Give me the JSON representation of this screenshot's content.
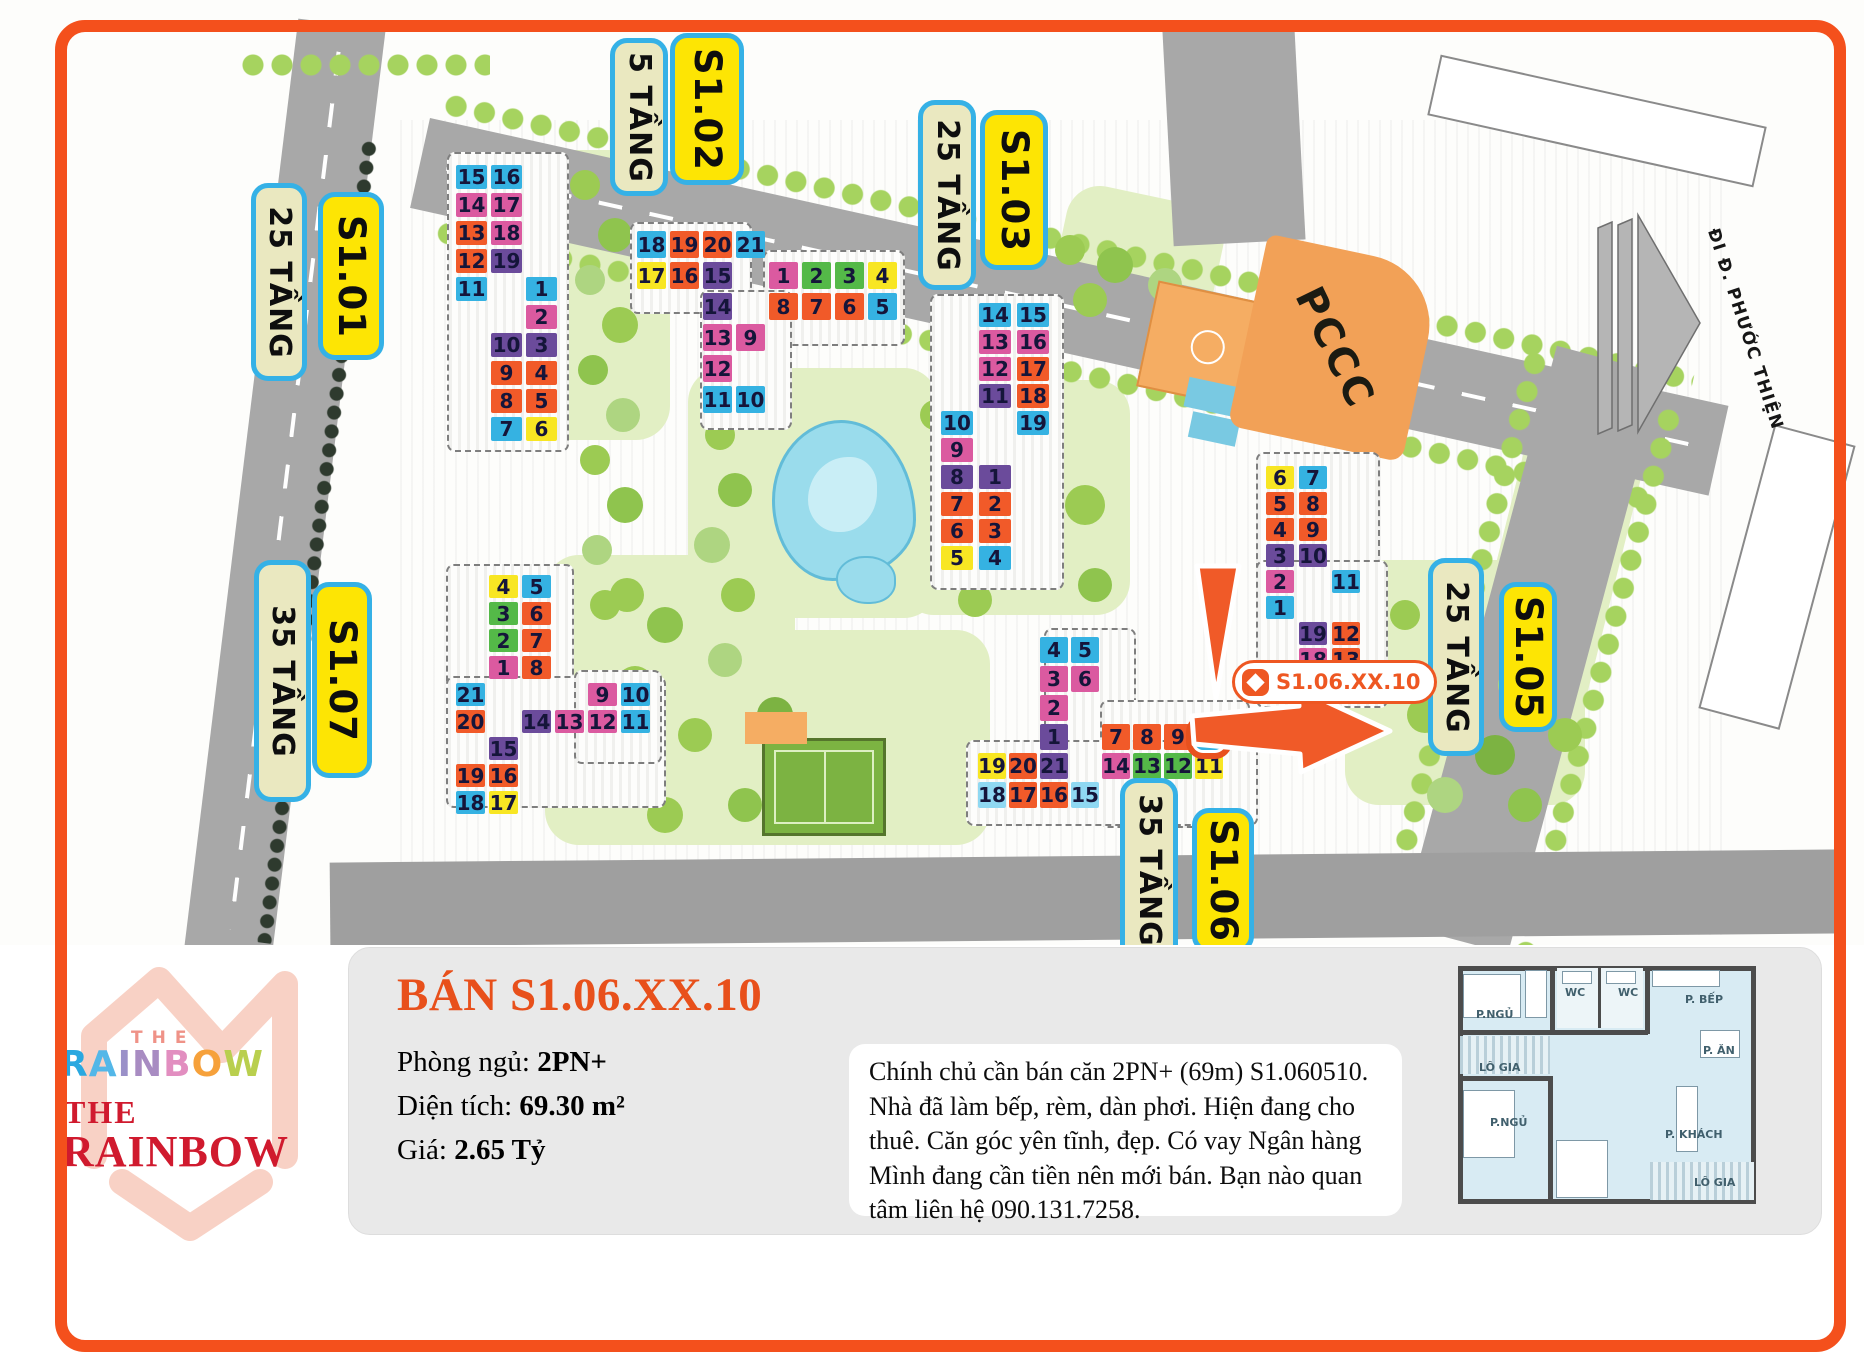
{
  "frame": {
    "border_color": "#f4501c"
  },
  "logo": {
    "the_small": "THE",
    "rainbow_letters": [
      {
        "ch": "R",
        "color": "#29a8e0"
      },
      {
        "ch": "A",
        "color": "#53b7e8"
      },
      {
        "ch": "I",
        "color": "#9a90c8"
      },
      {
        "ch": "N",
        "color": "#a88cc2"
      },
      {
        "ch": "B",
        "color": "#e28ec0"
      },
      {
        "ch": "O",
        "color": "#f6a13b"
      },
      {
        "ch": "W",
        "color": "#b9cf4e"
      }
    ],
    "the_red": "THE",
    "rainbow_red": "RAINBOW"
  },
  "panel": {
    "title": "BÁN S1.06.XX.10",
    "fields": [
      {
        "label": "Phòng ngủ: ",
        "value": "2PN+"
      },
      {
        "label": "Diện tích: ",
        "value": "69.30 m²"
      },
      {
        "label": "Giá: ",
        "value": "2.65 Tỷ"
      }
    ],
    "description": "Chính chủ cần bán căn 2PN+ (69m) S1.060510. Nhà đã làm bếp, rèm, dàn phơi. Hiện đang cho thuê. Căn góc yên tĩnh, đẹp. Có vay Ngân hàng Mình đang cần tiền nên mới bán. Bạn nào quan tâm liên hệ 090.131.7258."
  },
  "floorplan": {
    "labels": [
      {
        "text": "P.NGỦ",
        "x": 1476,
        "y": 1008
      },
      {
        "text": "WC",
        "x": 1565,
        "y": 986
      },
      {
        "text": "WC",
        "x": 1618,
        "y": 986
      },
      {
        "text": "P. BẾP",
        "x": 1685,
        "y": 993
      },
      {
        "text": "P. ĂN",
        "x": 1703,
        "y": 1044
      },
      {
        "text": "LÔ GIA",
        "x": 1479,
        "y": 1061
      },
      {
        "text": "P.NGỦ",
        "x": 1490,
        "y": 1116
      },
      {
        "text": "P. KHÁCH",
        "x": 1665,
        "y": 1128
      },
      {
        "text": "LÔ GIA",
        "x": 1694,
        "y": 1176
      }
    ]
  },
  "map": {
    "street_label": "ĐI Đ. PHƯỚC THIỆN",
    "pccc_label": "PCCC",
    "tooltip": {
      "text": "S1.06.XX.10"
    },
    "palette": {
      "c": "#35b2e2",
      "m": "#db5aa0",
      "o": "#f15a29",
      "p": "#6b4b9b",
      "y": "#f8e623",
      "g": "#54b948",
      "lc": "#8fd8f2"
    },
    "labels": [
      {
        "text": "25 TẦNG",
        "kind": "floors",
        "x": 251,
        "y": 183,
        "w": 56,
        "h": 198
      },
      {
        "text": "S1.01",
        "kind": "name",
        "x": 318,
        "y": 192,
        "w": 66,
        "h": 168
      },
      {
        "text": "5 TẦNG",
        "kind": "floors",
        "x": 610,
        "y": 38,
        "w": 58,
        "h": 158
      },
      {
        "text": "S1.02",
        "kind": "name",
        "x": 670,
        "y": 33,
        "w": 74,
        "h": 152
      },
      {
        "text": "25 TẦNG",
        "kind": "floors",
        "x": 918,
        "y": 100,
        "w": 58,
        "h": 190
      },
      {
        "text": "S1.03",
        "kind": "name",
        "x": 980,
        "y": 110,
        "w": 68,
        "h": 160
      },
      {
        "text": "25 TẦNG",
        "kind": "floors",
        "x": 1428,
        "y": 558,
        "w": 56,
        "h": 198
      },
      {
        "text": "S1.05",
        "kind": "name",
        "x": 1499,
        "y": 582,
        "w": 58,
        "h": 150
      },
      {
        "text": "35 TẦNG",
        "kind": "floors",
        "x": 254,
        "y": 560,
        "w": 57,
        "h": 242
      },
      {
        "text": "S1.07",
        "kind": "name",
        "x": 312,
        "y": 582,
        "w": 60,
        "h": 196
      },
      {
        "text": "35 TẦNG",
        "kind": "floors",
        "x": 1120,
        "y": 778,
        "w": 58,
        "h": 185
      },
      {
        "text": "S1.06",
        "kind": "name",
        "x": 1192,
        "y": 808,
        "w": 62,
        "h": 145
      }
    ],
    "buildings": [
      {
        "id": "s101",
        "x": 456,
        "y": 165,
        "cols": 3,
        "rows": 10,
        "cw": 31,
        "ch": 24,
        "cg": 4,
        "rg": 4,
        "plots": [
          [
            447,
            152,
            122,
            300
          ]
        ],
        "units": [
          [
            15,
            "c",
            1,
            1
          ],
          [
            16,
            "c",
            2,
            1
          ],
          [
            14,
            "m",
            1,
            2
          ],
          [
            17,
            "m",
            2,
            2
          ],
          [
            13,
            "o",
            1,
            3
          ],
          [
            18,
            "m",
            2,
            3
          ],
          [
            12,
            "o",
            1,
            4
          ],
          [
            19,
            "p",
            2,
            4
          ],
          [
            11,
            "c",
            1,
            5
          ],
          [
            1,
            "c",
            3,
            5
          ],
          [
            2,
            "m",
            3,
            6
          ],
          [
            10,
            "p",
            2,
            7
          ],
          [
            3,
            "p",
            3,
            7
          ],
          [
            9,
            "o",
            2,
            8
          ],
          [
            4,
            "o",
            3,
            8
          ],
          [
            8,
            "o",
            2,
            9
          ],
          [
            5,
            "o",
            3,
            9
          ],
          [
            7,
            "c",
            2,
            10
          ],
          [
            6,
            "y",
            3,
            10
          ]
        ]
      },
      {
        "id": "s102",
        "x": 637,
        "y": 231,
        "cols": 8,
        "rows": 6,
        "cw": 29,
        "ch": 27,
        "cg": 4,
        "rg": 4,
        "plots": [
          [
            630,
            222,
            122,
            92
          ],
          [
            763,
            250,
            142,
            96
          ],
          [
            700,
            290,
            92,
            140
          ]
        ],
        "units": [
          [
            18,
            "c",
            1,
            1
          ],
          [
            19,
            "o",
            2,
            1
          ],
          [
            20,
            "o",
            3,
            1
          ],
          [
            21,
            "c",
            4,
            1
          ],
          [
            17,
            "y",
            1,
            2
          ],
          [
            16,
            "o",
            2,
            2
          ],
          [
            15,
            "p",
            3,
            2
          ],
          [
            1,
            "m",
            5,
            2
          ],
          [
            2,
            "g",
            6,
            2
          ],
          [
            3,
            "g",
            7,
            2
          ],
          [
            4,
            "y",
            8,
            2
          ],
          [
            14,
            "p",
            3,
            3
          ],
          [
            8,
            "o",
            5,
            3
          ],
          [
            7,
            "o",
            6,
            3
          ],
          [
            6,
            "o",
            7,
            3
          ],
          [
            5,
            "c",
            8,
            3
          ],
          [
            13,
            "m",
            3,
            4
          ],
          [
            9,
            "m",
            4,
            4
          ],
          [
            12,
            "m",
            3,
            5
          ],
          [
            11,
            "c",
            3,
            6
          ],
          [
            10,
            "c",
            4,
            6
          ]
        ]
      },
      {
        "id": "s103",
        "x": 941,
        "y": 303,
        "cols": 3,
        "rows": 10,
        "cw": 32,
        "ch": 24,
        "cg": 6,
        "rg": 3,
        "plots": [
          [
            930,
            294,
            134,
            296
          ]
        ],
        "units": [
          [
            14,
            "c",
            2,
            1
          ],
          [
            15,
            "c",
            3,
            1
          ],
          [
            13,
            "m",
            2,
            2
          ],
          [
            16,
            "m",
            3,
            2
          ],
          [
            12,
            "m",
            2,
            3
          ],
          [
            17,
            "o",
            3,
            3
          ],
          [
            11,
            "p",
            2,
            4
          ],
          [
            18,
            "o",
            3,
            4
          ],
          [
            10,
            "c",
            1,
            5
          ],
          [
            19,
            "c",
            3,
            5
          ],
          [
            9,
            "m",
            1,
            6
          ],
          [
            8,
            "p",
            1,
            7
          ],
          [
            1,
            "p",
            2,
            7
          ],
          [
            7,
            "o",
            1,
            8
          ],
          [
            2,
            "o",
            2,
            8
          ],
          [
            6,
            "o",
            1,
            9
          ],
          [
            3,
            "o",
            2,
            9
          ],
          [
            5,
            "y",
            1,
            10
          ],
          [
            4,
            "c",
            2,
            10
          ]
        ]
      },
      {
        "id": "s105",
        "x": 1266,
        "y": 466,
        "cols": 3,
        "rows": 9,
        "cw": 28,
        "ch": 23,
        "cg": 5,
        "rg": 3,
        "plots": [
          [
            1256,
            452,
            124,
            165
          ],
          [
            1256,
            560,
            132,
            148
          ]
        ],
        "units": [
          [
            6,
            "y",
            1,
            1
          ],
          [
            7,
            "c",
            2,
            1
          ],
          [
            5,
            "o",
            1,
            2
          ],
          [
            8,
            "o",
            2,
            2
          ],
          [
            4,
            "o",
            1,
            3
          ],
          [
            9,
            "o",
            2,
            3
          ],
          [
            3,
            "p",
            1,
            4
          ],
          [
            10,
            "p",
            2,
            4
          ],
          [
            2,
            "m",
            1,
            5
          ],
          [
            11,
            "c",
            3,
            5
          ],
          [
            1,
            "c",
            1,
            6
          ],
          [
            19,
            "p",
            2,
            7
          ],
          [
            12,
            "o",
            3,
            7
          ],
          [
            18,
            "m",
            2,
            8
          ],
          [
            13,
            "o",
            3,
            8
          ],
          [
            17,
            "m",
            2,
            9
          ],
          [
            14,
            "m",
            3,
            9
          ]
        ]
      },
      {
        "id": "s106",
        "x": 978,
        "y": 637,
        "cols": 8,
        "rows": 6,
        "cw": 28,
        "ch": 26,
        "cg": 3,
        "rg": 3,
        "plots": [
          [
            1044,
            628,
            92,
            192
          ],
          [
            1100,
            700,
            150,
            128
          ],
          [
            966,
            740,
            292,
            86
          ]
        ],
        "units": [
          [
            4,
            "c",
            3,
            1
          ],
          [
            5,
            "c",
            4,
            1
          ],
          [
            3,
            "m",
            3,
            2
          ],
          [
            6,
            "m",
            4,
            2
          ],
          [
            2,
            "m",
            3,
            3
          ],
          [
            1,
            "p",
            3,
            4
          ],
          [
            7,
            "o",
            5,
            4
          ],
          [
            8,
            "o",
            6,
            4
          ],
          [
            9,
            "o",
            7,
            4
          ],
          [
            10,
            "c",
            8,
            4,
            1
          ],
          [
            19,
            "y",
            1,
            5
          ],
          [
            20,
            "o",
            2,
            5
          ],
          [
            21,
            "p",
            3,
            5
          ],
          [
            14,
            "m",
            5,
            5
          ],
          [
            13,
            "g",
            6,
            5
          ],
          [
            12,
            "g",
            7,
            5
          ],
          [
            11,
            "y",
            8,
            5
          ],
          [
            18,
            "lc",
            1,
            6
          ],
          [
            17,
            "o",
            2,
            6
          ],
          [
            16,
            "o",
            3,
            6
          ],
          [
            15,
            "lc",
            4,
            6
          ]
        ]
      },
      {
        "id": "s107",
        "x": 456,
        "y": 575,
        "cols": 6,
        "rows": 9,
        "cw": 29,
        "ch": 23,
        "cg": 4,
        "rg": 4,
        "plots": [
          [
            446,
            564,
            128,
            152
          ],
          [
            446,
            676,
            220,
            132
          ],
          [
            574,
            670,
            88,
            94
          ]
        ],
        "units": [
          [
            4,
            "y",
            2,
            1
          ],
          [
            5,
            "c",
            3,
            1
          ],
          [
            3,
            "g",
            2,
            2
          ],
          [
            6,
            "o",
            3,
            2
          ],
          [
            2,
            "g",
            2,
            3
          ],
          [
            7,
            "o",
            3,
            3
          ],
          [
            1,
            "m",
            2,
            4
          ],
          [
            8,
            "o",
            3,
            4
          ],
          [
            21,
            "c",
            1,
            5
          ],
          [
            9,
            "m",
            5,
            5
          ],
          [
            10,
            "c",
            6,
            5
          ],
          [
            20,
            "o",
            1,
            6
          ],
          [
            14,
            "p",
            3,
            6
          ],
          [
            13,
            "m",
            4,
            6
          ],
          [
            12,
            "m",
            5,
            6
          ],
          [
            11,
            "c",
            6,
            6
          ],
          [
            15,
            "p",
            2,
            7
          ],
          [
            19,
            "o",
            1,
            8
          ],
          [
            16,
            "o",
            2,
            8
          ],
          [
            18,
            "c",
            1,
            9
          ],
          [
            17,
            "y",
            2,
            9
          ]
        ]
      }
    ]
  }
}
